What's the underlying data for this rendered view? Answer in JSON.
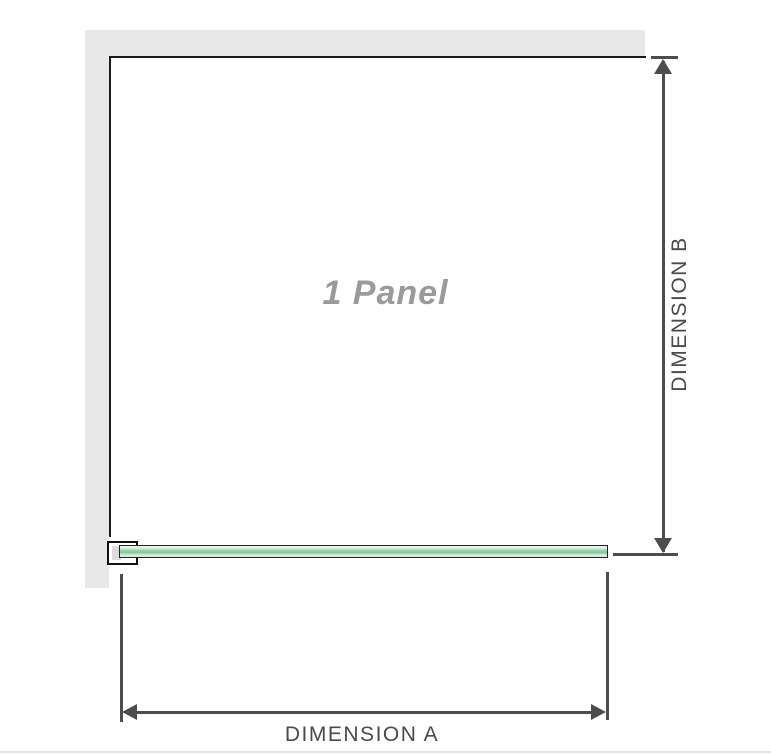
{
  "diagram": {
    "panel_label": "1 Panel",
    "dimension_a": {
      "label": "DIMENSION A"
    },
    "dimension_b": {
      "label": "DIMENSION B"
    }
  },
  "colors": {
    "wall_fill": "#e8e8e8",
    "wall_edge": "#1a1a1a",
    "bracket_outline": "#111111",
    "bracket_shadow": "#dcdcdc",
    "glass_outline": "#222222",
    "glass_light": "#d2e9d7",
    "glass_mid": "#8fcea5",
    "dimension_line": "#4d4d4d",
    "dimension_text": "#4a4a4a",
    "panel_label_text": "#9a9a9a",
    "page_rule": "#e7e3df"
  }
}
